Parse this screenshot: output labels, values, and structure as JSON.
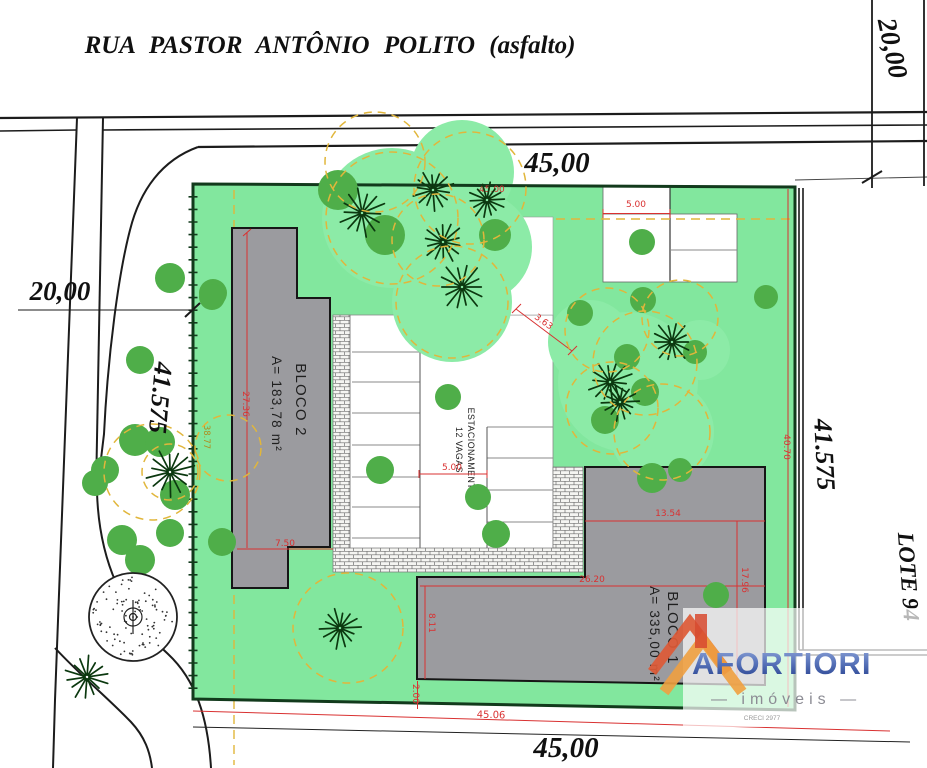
{
  "street": {
    "name": "RUA PASTOR ANTÔNIO POLITO (asfalto)"
  },
  "site": {
    "front_width": "45,00",
    "rear_width": "45,00",
    "left_depth": "41.575",
    "right_depth": "41.575",
    "left_road_width": "20,00",
    "right_road_width": "20,00",
    "neighbor_lot": "LOTE 94"
  },
  "buildings": {
    "bloco1": {
      "name": "BLOCO 1",
      "area": "A= 335,00 m²"
    },
    "bloco2": {
      "name": "BLOCO 2",
      "area": "A= 183,78 m²"
    }
  },
  "parking": {
    "line1": "ESTACIONAMENTO",
    "line2": "12 VAGAS"
  },
  "red_dims": {
    "front_inner": "45.00",
    "entry_width": "5.00",
    "aisle_width": "5.00",
    "tree_gap": "3.63",
    "bloco2_length": "27.36",
    "bloco2_width": "7.50",
    "left_offset": "38.77",
    "bloco1_top_width": "13.54",
    "bloco1_width": "26.20",
    "bloco1_depth": "17.96",
    "bloco1_left_depth": "8.11",
    "rear_strip": "2.00",
    "right_inner": "40.70",
    "rear_inner": "45.06"
  },
  "logo": {
    "brand": "AFORTIORI",
    "tagline": "— imóveis —",
    "creci": "CRECI 2977"
  },
  "colors": {
    "site_green": "#82E79E",
    "canopy": "#8CEBA7",
    "tree_dark": "#4FAE49",
    "ring_yellow": "#E1B63B",
    "building_gray": "#9B9B9F",
    "dim_red": "#D93131",
    "boundary_green": "#123A1C",
    "burst_dark": "#0B380F",
    "logo_blue": "#3A57A6"
  },
  "trees": {
    "canopies": [
      {
        "x": 392,
        "y": 218,
        "r": 70
      },
      {
        "x": 462,
        "y": 172,
        "r": 52
      },
      {
        "x": 477,
        "y": 247,
        "r": 55
      },
      {
        "x": 452,
        "y": 302,
        "r": 60
      },
      {
        "x": 628,
        "y": 382,
        "r": 70
      },
      {
        "x": 590,
        "y": 342,
        "r": 42
      },
      {
        "x": 662,
        "y": 432,
        "r": 52
      },
      {
        "x": 700,
        "y": 350,
        "r": 30
      }
    ],
    "rings": [
      {
        "x": 375,
        "y": 162,
        "r": 50
      },
      {
        "x": 470,
        "y": 188,
        "r": 56
      },
      {
        "x": 438,
        "y": 240,
        "r": 46
      },
      {
        "x": 392,
        "y": 218,
        "r": 66
      },
      {
        "x": 452,
        "y": 302,
        "r": 56
      },
      {
        "x": 607,
        "y": 330,
        "r": 42
      },
      {
        "x": 645,
        "y": 363,
        "r": 52
      },
      {
        "x": 612,
        "y": 408,
        "r": 46
      },
      {
        "x": 680,
        "y": 318,
        "r": 38
      },
      {
        "x": 662,
        "y": 432,
        "r": 48
      },
      {
        "x": 152,
        "y": 472,
        "r": 48
      },
      {
        "x": 170,
        "y": 472,
        "r": 28
      },
      {
        "x": 228,
        "y": 448,
        "r": 33
      },
      {
        "x": 348,
        "y": 628,
        "r": 55
      }
    ],
    "circles": [
      {
        "x": 170,
        "y": 278,
        "r": 15
      },
      {
        "x": 213,
        "y": 293,
        "r": 14
      },
      {
        "x": 140,
        "y": 360,
        "r": 14
      },
      {
        "x": 338,
        "y": 190,
        "r": 20
      },
      {
        "x": 385,
        "y": 235,
        "r": 20
      },
      {
        "x": 495,
        "y": 235,
        "r": 16
      },
      {
        "x": 212,
        "y": 297,
        "r": 13
      },
      {
        "x": 580,
        "y": 313,
        "r": 13
      },
      {
        "x": 643,
        "y": 300,
        "r": 13
      },
      {
        "x": 642,
        "y": 242,
        "r": 13
      },
      {
        "x": 627,
        "y": 357,
        "r": 13
      },
      {
        "x": 645,
        "y": 392,
        "r": 14
      },
      {
        "x": 605,
        "y": 420,
        "r": 14
      },
      {
        "x": 695,
        "y": 352,
        "r": 12
      },
      {
        "x": 766,
        "y": 297,
        "r": 12
      },
      {
        "x": 448,
        "y": 397,
        "r": 13
      },
      {
        "x": 478,
        "y": 497,
        "r": 13
      },
      {
        "x": 496,
        "y": 534,
        "r": 14
      },
      {
        "x": 380,
        "y": 470,
        "r": 14
      },
      {
        "x": 716,
        "y": 595,
        "r": 13
      },
      {
        "x": 652,
        "y": 478,
        "r": 15
      },
      {
        "x": 680,
        "y": 470,
        "r": 12
      },
      {
        "x": 135,
        "y": 440,
        "r": 16
      },
      {
        "x": 160,
        "y": 442,
        "r": 15
      },
      {
        "x": 105,
        "y": 470,
        "r": 14
      },
      {
        "x": 95,
        "y": 483,
        "r": 13
      },
      {
        "x": 175,
        "y": 495,
        "r": 15
      },
      {
        "x": 122,
        "y": 540,
        "r": 15
      },
      {
        "x": 140,
        "y": 560,
        "r": 15
      },
      {
        "x": 170,
        "y": 533,
        "r": 14
      },
      {
        "x": 222,
        "y": 542,
        "r": 14
      }
    ],
    "bursts": [
      {
        "x": 362,
        "y": 213,
        "r": 26
      },
      {
        "x": 433,
        "y": 190,
        "r": 22
      },
      {
        "x": 487,
        "y": 200,
        "r": 20
      },
      {
        "x": 443,
        "y": 242,
        "r": 22
      },
      {
        "x": 462,
        "y": 287,
        "r": 26
      },
      {
        "x": 672,
        "y": 342,
        "r": 22
      },
      {
        "x": 610,
        "y": 382,
        "r": 24
      },
      {
        "x": 620,
        "y": 402,
        "r": 20
      },
      {
        "x": 170,
        "y": 472,
        "r": 26
      },
      {
        "x": 340,
        "y": 628,
        "r": 22
      },
      {
        "x": 87,
        "y": 677,
        "r": 24
      }
    ],
    "stipple": {
      "x": 133,
      "y": 617,
      "r": 44
    }
  }
}
